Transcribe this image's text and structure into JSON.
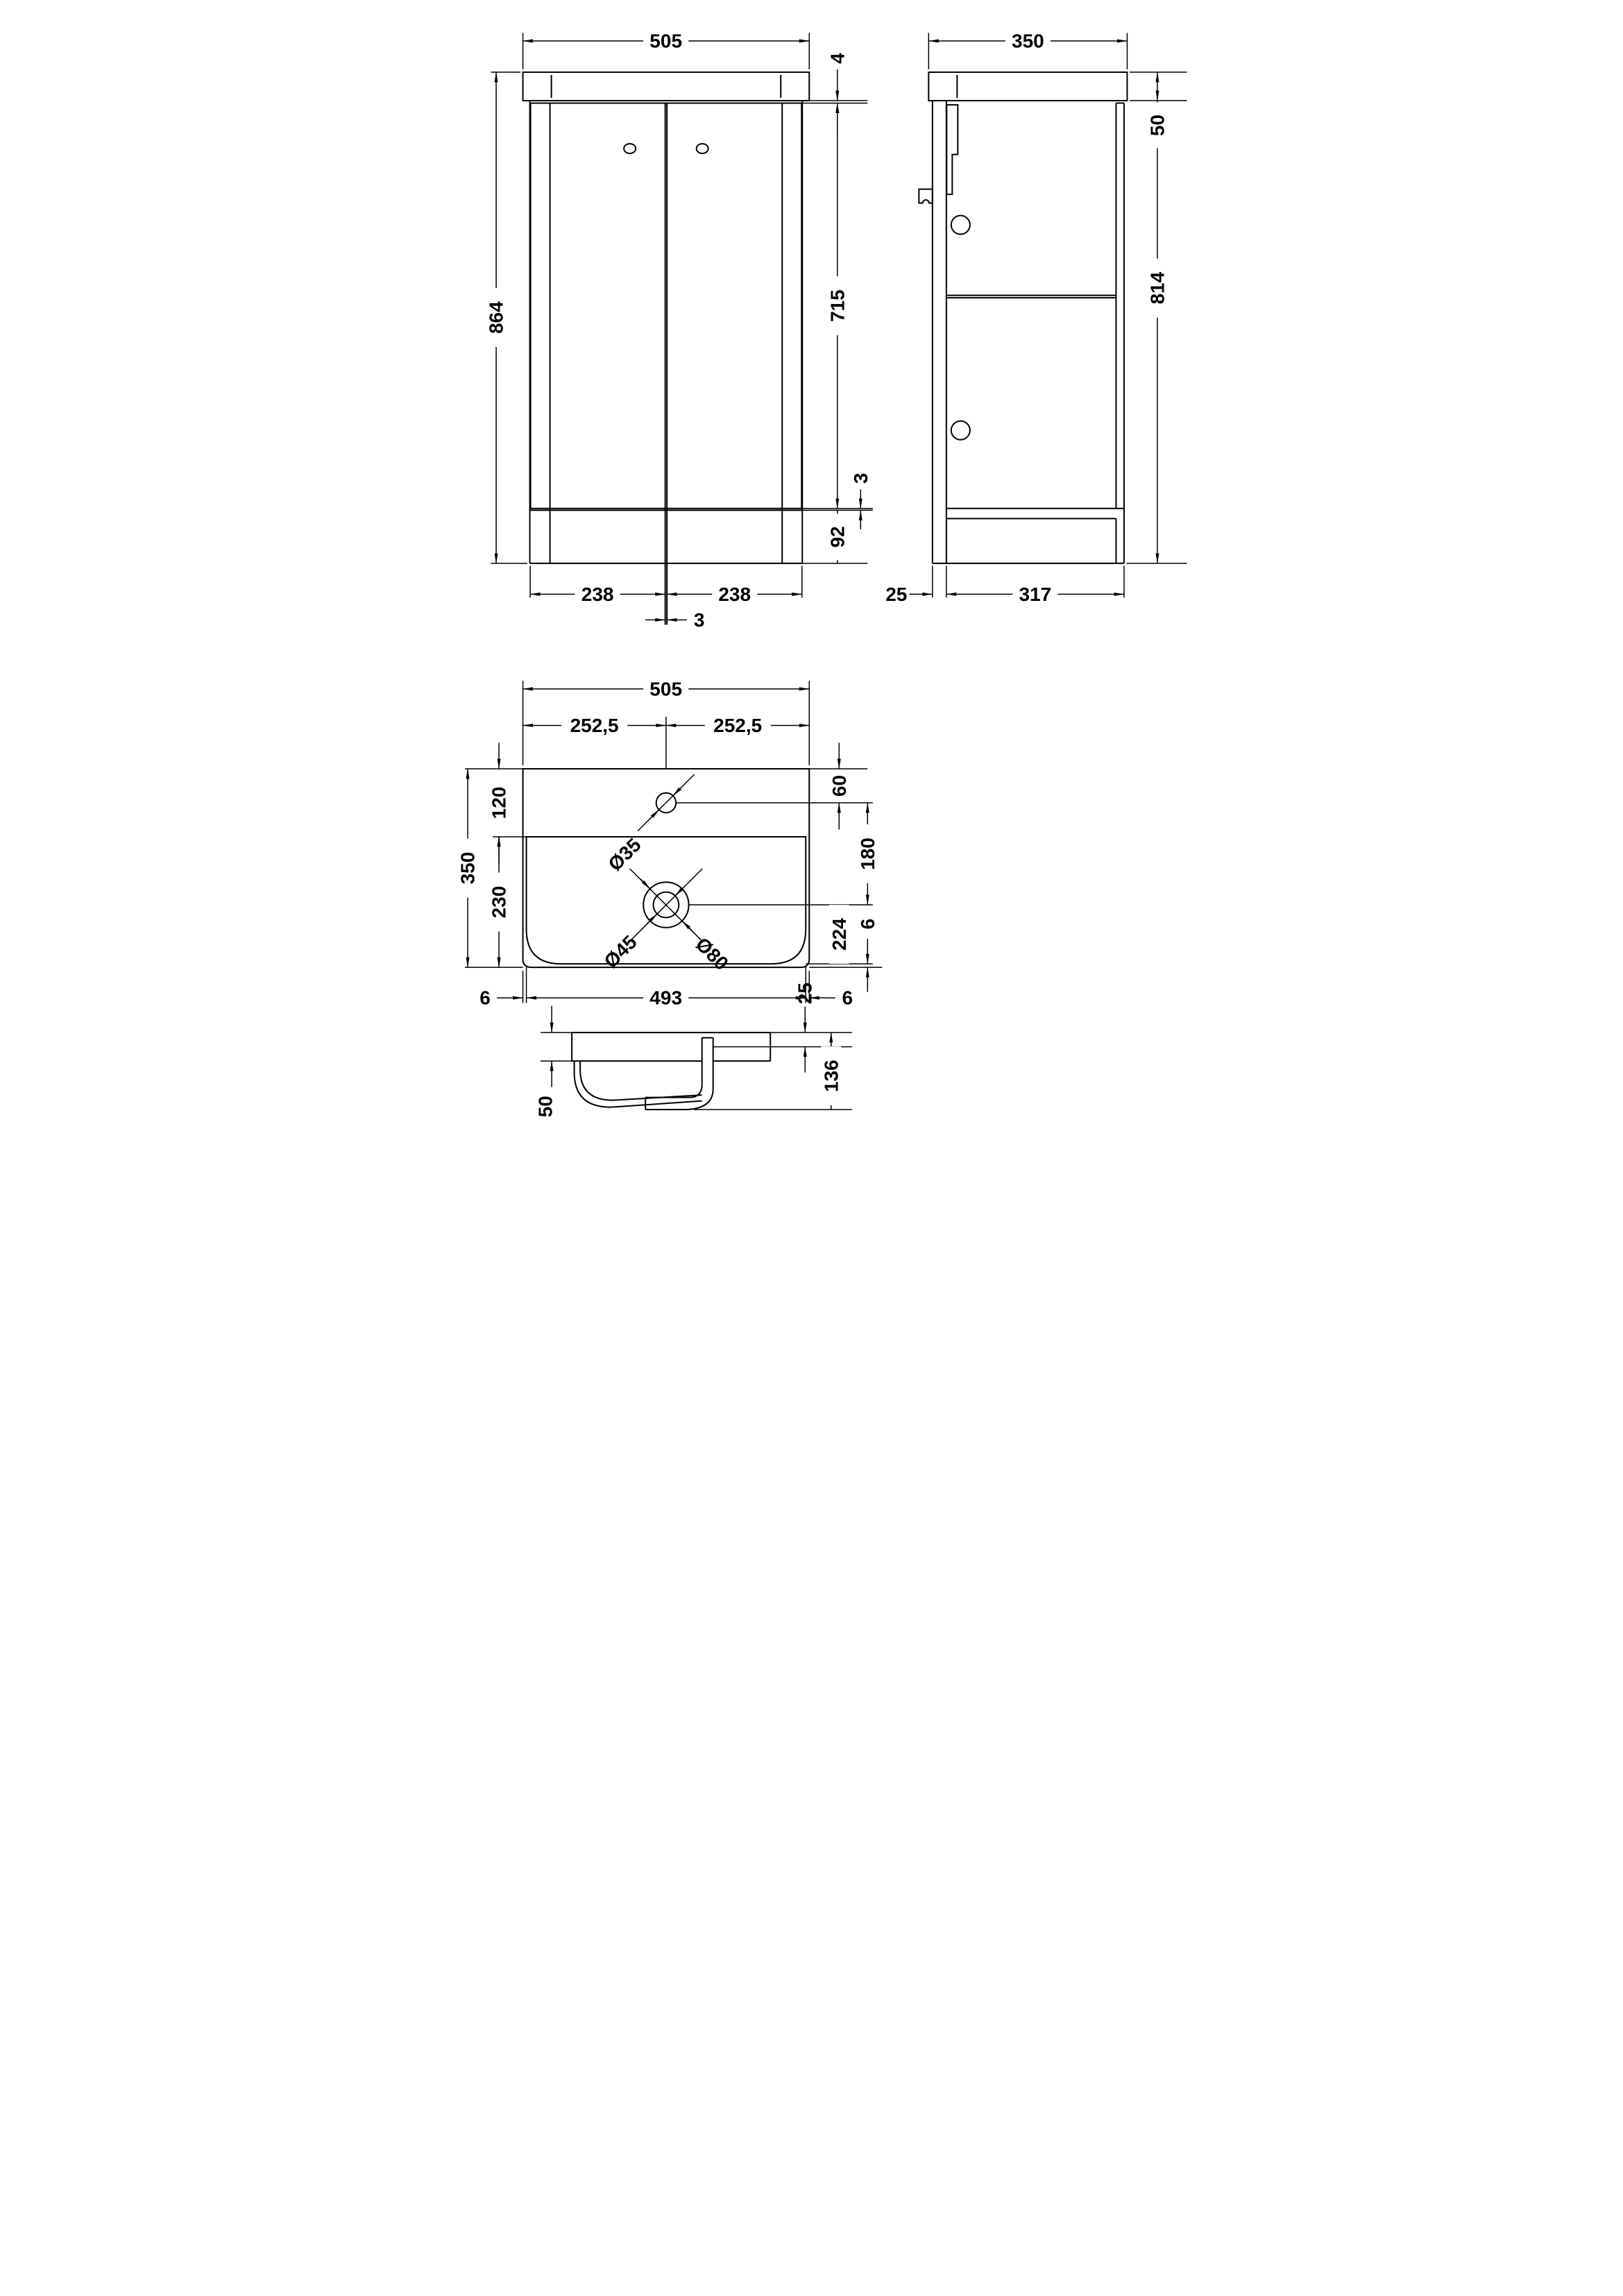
{
  "colors": {
    "line": "#000000",
    "background": "#ffffff"
  },
  "front_view": {
    "width": "505",
    "height": "864",
    "top_gap": "4",
    "door_height": "715",
    "door_bottom_gap": "3",
    "plinth_height": "92",
    "door_width_left": "238",
    "door_width_right": "238",
    "center_gap": "3"
  },
  "side_view": {
    "depth": "350",
    "worktop_thickness": "50",
    "cabinet_height": "814",
    "back_inset": "25",
    "base_depth": "317"
  },
  "plan_view": {
    "width": "505",
    "half_width_left": "252,5",
    "half_width_right": "252,5",
    "back_band": "120",
    "bowl_band": "230",
    "depth": "350",
    "tap_offset": "60",
    "tap_to_waste": "180",
    "waste_band": "224",
    "rim_thickness": "6",
    "edge_left": "6",
    "inner_width": "493",
    "edge_right": "6",
    "tap_hole_dia": "Ø35",
    "waste_dia_inner": "Ø45",
    "waste_dia_outer": "Ø80"
  },
  "section_view": {
    "basin_thickness": "50",
    "outlet_offset": "25",
    "total_depth": "136"
  }
}
